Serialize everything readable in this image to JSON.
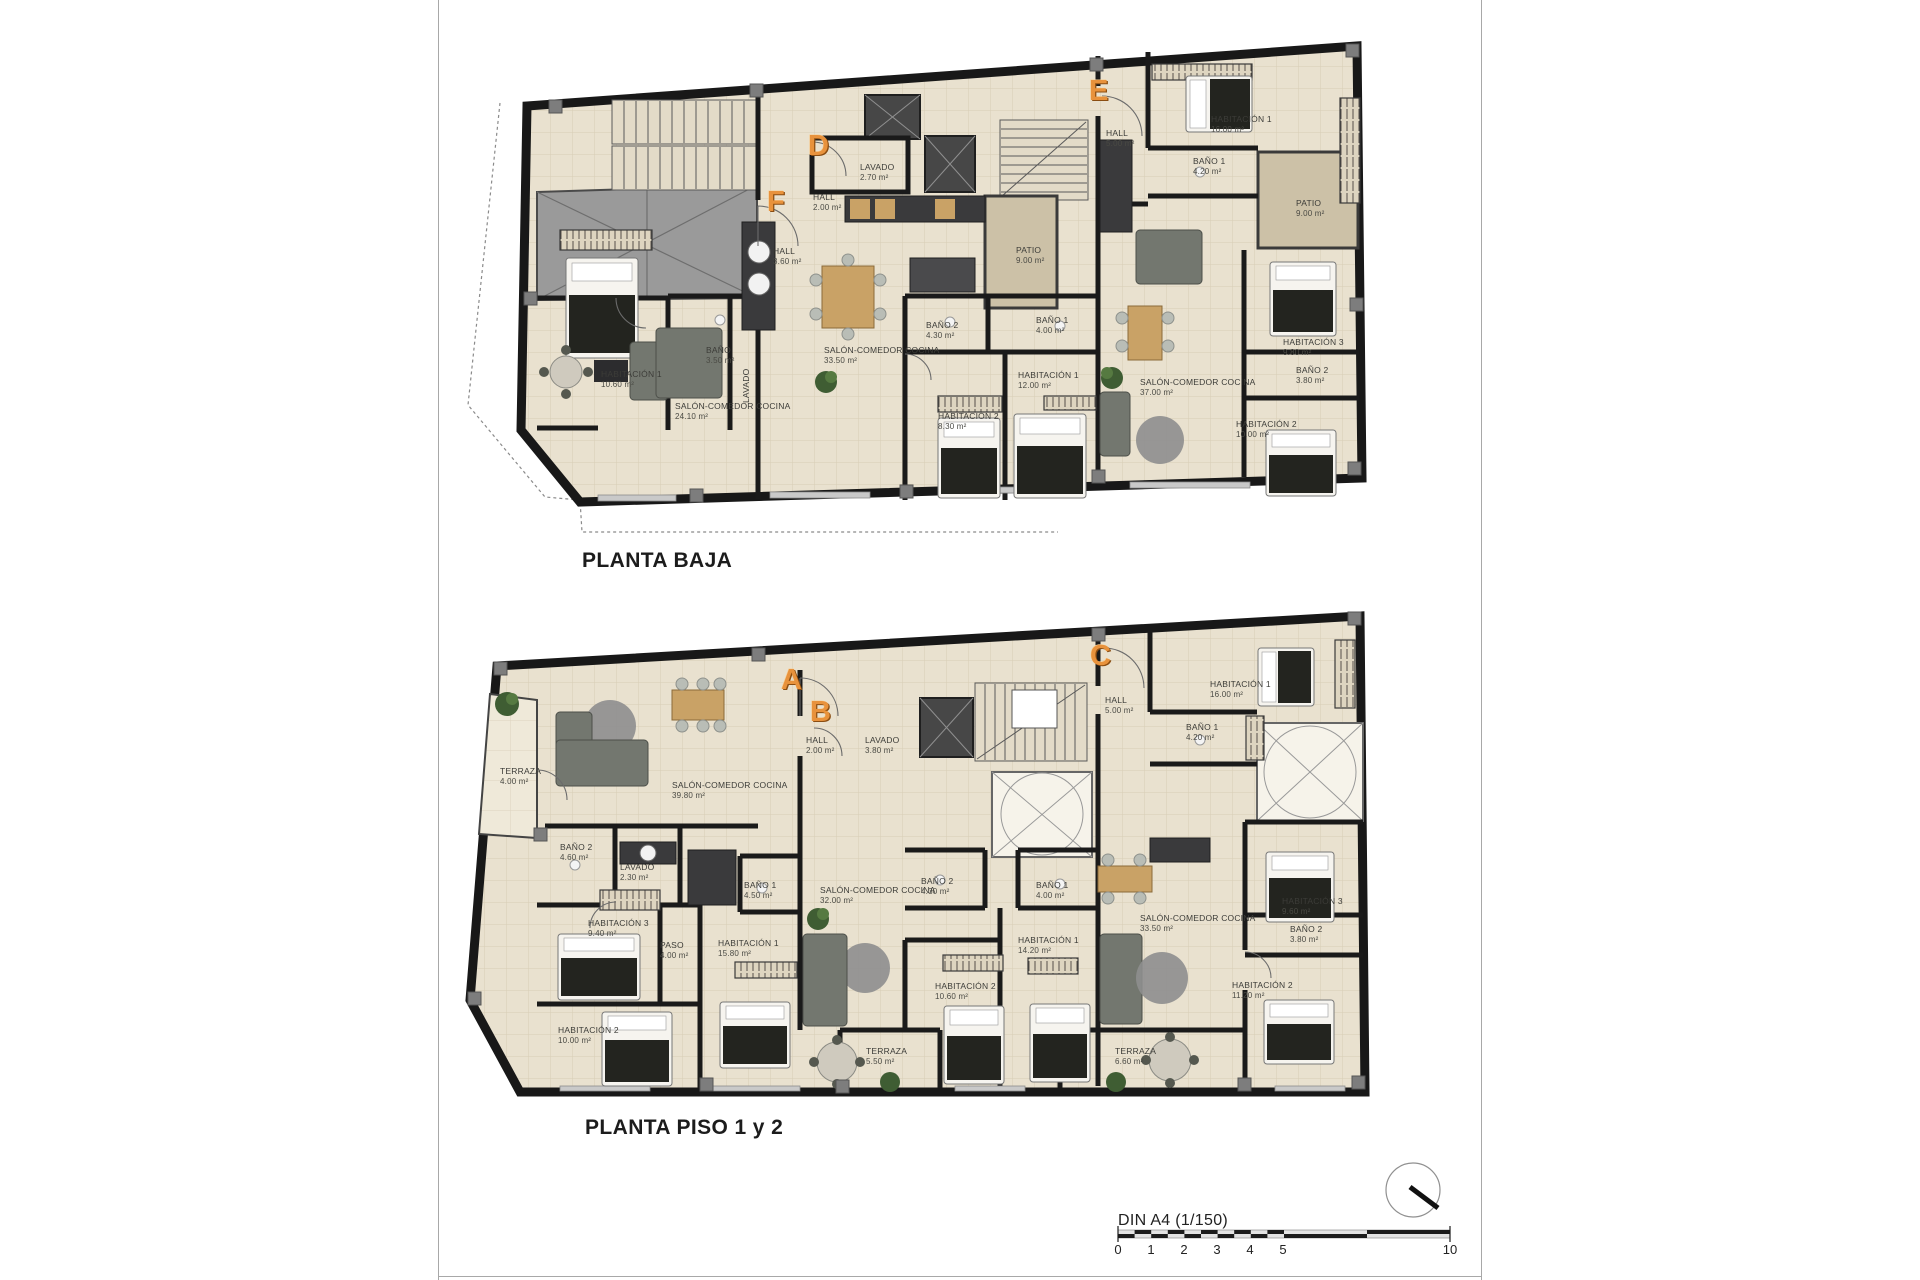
{
  "page": {
    "background": "#ffffff",
    "border_color": "#a8a8a8"
  },
  "colors": {
    "apartment_letter": "#e8923c",
    "wall": "#1a1a1a",
    "floor_tile": "#e9e1cf",
    "roof_gray": "#9a9a9a",
    "patio_tan": "#ccc1a7"
  },
  "plans": [
    {
      "title": "PLANTA BAJA",
      "apartments": [
        {
          "letter": "F"
        },
        {
          "letter": "D"
        },
        {
          "letter": "E"
        }
      ],
      "rooms": [
        {
          "name": "HALL",
          "area": "3.60 m²"
        },
        {
          "name": "HABITACIÓN 1",
          "area": "10.60 m²"
        },
        {
          "name": "BAÑO",
          "area": "3.50 m²"
        },
        {
          "name": "LAVADO",
          "area": ""
        },
        {
          "name": "SALÓN-COMEDOR COCINA",
          "area": "24.10 m²"
        },
        {
          "name": "HALL",
          "area": "2.00 m²"
        },
        {
          "name": "LAVADO",
          "area": "2.70 m²"
        },
        {
          "name": "SALÓN-COMEDOR COCINA",
          "area": "33.50 m²"
        },
        {
          "name": "PATIO",
          "area": "9.00 m²"
        },
        {
          "name": "BAÑO 2",
          "area": "4.30 m²"
        },
        {
          "name": "BAÑO 1",
          "area": "4.00 m²"
        },
        {
          "name": "HABITACIÓN 1",
          "area": "12.00 m²"
        },
        {
          "name": "HABITACIÓN 2",
          "area": "8.30 m²"
        },
        {
          "name": "HALL",
          "area": "5.00 m²"
        },
        {
          "name": "HABITACIÓN 1",
          "area": "16.00 m²"
        },
        {
          "name": "BAÑO 1",
          "area": "4.20 m²"
        },
        {
          "name": "PATIO",
          "area": "9.00 m²"
        },
        {
          "name": "SALÓN-COMEDOR COCINA",
          "area": "37.00 m²"
        },
        {
          "name": "HABITACIÓN 3",
          "area": "9.80 m²"
        },
        {
          "name": "BAÑO 2",
          "area": "3.80 m²"
        },
        {
          "name": "HABITACIÓN 2",
          "area": "10.00 m²"
        }
      ]
    },
    {
      "title": "PLANTA PISO 1 y 2",
      "apartments": [
        {
          "letter": "A"
        },
        {
          "letter": "B"
        },
        {
          "letter": "C"
        }
      ],
      "rooms": [
        {
          "name": "TERRAZA",
          "area": "4.00 m²"
        },
        {
          "name": "SALÓN-COMEDOR COCINA",
          "area": "39.80 m²"
        },
        {
          "name": "BAÑO 2",
          "area": "4.60 m²"
        },
        {
          "name": "LAVADO",
          "area": "2.30 m²"
        },
        {
          "name": "HABITACIÓN 3",
          "area": "9.40 m²"
        },
        {
          "name": "PASO",
          "area": "4.00 m²"
        },
        {
          "name": "BAÑO 1",
          "area": "4.50 m²"
        },
        {
          "name": "HABITACIÓN 1",
          "area": "15.80 m²"
        },
        {
          "name": "HABITACIÓN 2",
          "area": "10.00 m²"
        },
        {
          "name": "HALL",
          "area": "2.00 m²"
        },
        {
          "name": "LAVADO",
          "area": "3.80 m²"
        },
        {
          "name": "SALÓN-COMEDOR COCINA",
          "area": "32.00 m²"
        },
        {
          "name": "BAÑO 2",
          "area": "4.30 m²"
        },
        {
          "name": "BAÑO 1",
          "area": "4.00 m²"
        },
        {
          "name": "HABITACIÓN 1",
          "area": "14.20 m²"
        },
        {
          "name": "HABITACIÓN 2",
          "area": "10.60 m²"
        },
        {
          "name": "TERRAZA",
          "area": "5.50 m²"
        },
        {
          "name": "HALL",
          "area": "5.00 m²"
        },
        {
          "name": "HABITACIÓN 1",
          "area": "16.00 m²"
        },
        {
          "name": "BAÑO 1",
          "area": "4.20 m²"
        },
        {
          "name": "SALÓN-COMEDOR COCINA",
          "area": "33.50 m²"
        },
        {
          "name": "HABITACIÓN 3",
          "area": "9.60 m²"
        },
        {
          "name": "BAÑO 2",
          "area": "3.80 m²"
        },
        {
          "name": "HABITACIÓN 2",
          "area": "11.20 m²"
        },
        {
          "name": "TERRAZA",
          "area": "6.60 m²"
        }
      ]
    }
  ],
  "scale_bar": {
    "label": "DIN A4 (1/150)",
    "ticks": [
      "0",
      "1",
      "2",
      "3",
      "4",
      "5",
      "10"
    ]
  }
}
